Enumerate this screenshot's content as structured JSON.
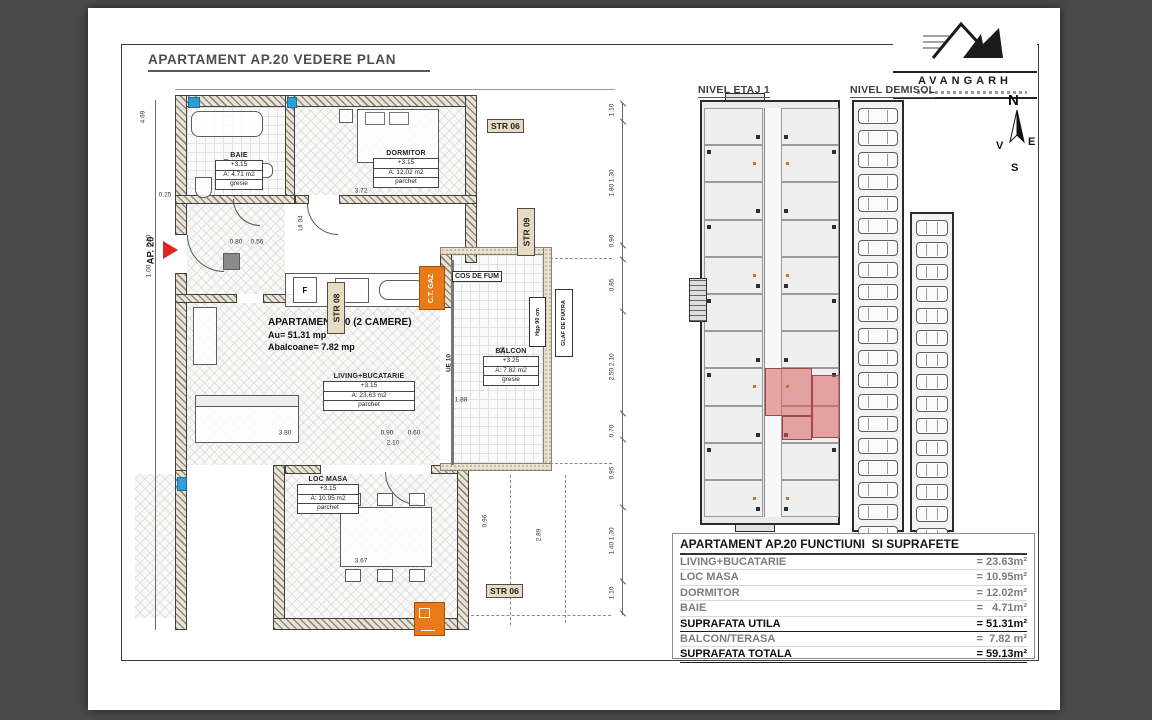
{
  "page": {
    "title": "APARTAMENT AP.20 VEDERE PLAN"
  },
  "logo": {
    "name": "AVANGARH"
  },
  "compass": {
    "n": "N",
    "s": "S",
    "e": "E",
    "w": "V"
  },
  "overview_plans": {
    "etaj": {
      "label": "NIVEL ETAJ 1"
    },
    "demisol": {
      "label": "NIVEL DEMISOL",
      "left_cars": 21,
      "right_cars": 15
    }
  },
  "main_plan": {
    "marker": {
      "label": "AP. 20"
    },
    "annotation": {
      "line1": "APARTAMENT 20 (2 CAMERE)",
      "line2": "Au= 51.31 mp",
      "line3": "Abalcoane= 7.82 mp"
    },
    "rooms": [
      {
        "name": "BAIE",
        "level": "+3.15",
        "area": "A: 4.71 m2",
        "finish": "gresie"
      },
      {
        "name": "DORMITOR",
        "level": "+3.15",
        "area": "A: 12.02 m2",
        "finish": "parchet"
      },
      {
        "name": "LIVING+BUCATARIE",
        "level": "+3.15",
        "area": "A: 23.63 m2",
        "finish": "parchet"
      },
      {
        "name": "LOC MASA",
        "level": "+3.15",
        "area": "A: 10.95 m2",
        "finish": "parchet"
      },
      {
        "name": "BALCON",
        "level": "+3.25",
        "area": "A: 7.82 m2",
        "finish": "gresie"
      }
    ],
    "tags": {
      "str06_top": "STR 06",
      "str06_bottom": "STR 06",
      "str08": "STR 08",
      "str09": "STR 09",
      "cos_de_fum": "COS DE FUM",
      "ct_gaz": "C.T. GAZ",
      "glaf": "GLAF DE PIATRA",
      "hgp": "Hgp 90 cm",
      "ue10": "UE 10",
      "ui04": "UI 04",
      "fridge": "F"
    },
    "dims_right": [
      {
        "v": "1.10"
      },
      {
        "v": "1.80",
        "v2": "1.30"
      },
      {
        "v": "0.90"
      },
      {
        "v": "0.85"
      },
      {
        "v": "2.50",
        "v2": "2.10"
      },
      {
        "v": "0.70"
      },
      {
        "v": "0.95"
      },
      {
        "v": "1.40",
        "v2": "1.30"
      },
      {
        "v": "1.10"
      }
    ],
    "dims_left": [
      "4.69",
      "0.25",
      "2.10",
      "1.00"
    ],
    "dims_inner": [
      "3.72",
      "2.13",
      "0.80",
      "0.56",
      "3.80",
      "0.90",
      "0.60",
      "2.10",
      "1.88",
      "4.26",
      "0.96",
      "3.67",
      "2.89"
    ]
  },
  "area_table": {
    "title": "APARTAMENT AP.20 FUNCTIUNI  SI SUPRAFETE",
    "rows": [
      {
        "label": "LIVING+BUCATARIE",
        "value": "= 23.63m²"
      },
      {
        "label": "LOC MASA",
        "value": "= 10.95m²"
      },
      {
        "label": "DORMITOR",
        "value": "= 12.02m²"
      },
      {
        "label": "BAIE",
        "value": "=   4.71m²"
      },
      {
        "label": "SUPRAFATA UTILA",
        "value": "= 51.31m²",
        "strong": true
      },
      {
        "label": "BALCON/TERASA",
        "value": "=  7.82 m²"
      },
      {
        "label": "SUPRAFATA TOTALA",
        "value": "= 59.13m²",
        "strong": true
      }
    ]
  },
  "colors": {
    "accent_orange": "#e87b17",
    "highlight_red": "#d66060",
    "marker_red": "#e02421",
    "tag_beige": "#e7dcc3",
    "window_blue": "#2d9fd8"
  }
}
